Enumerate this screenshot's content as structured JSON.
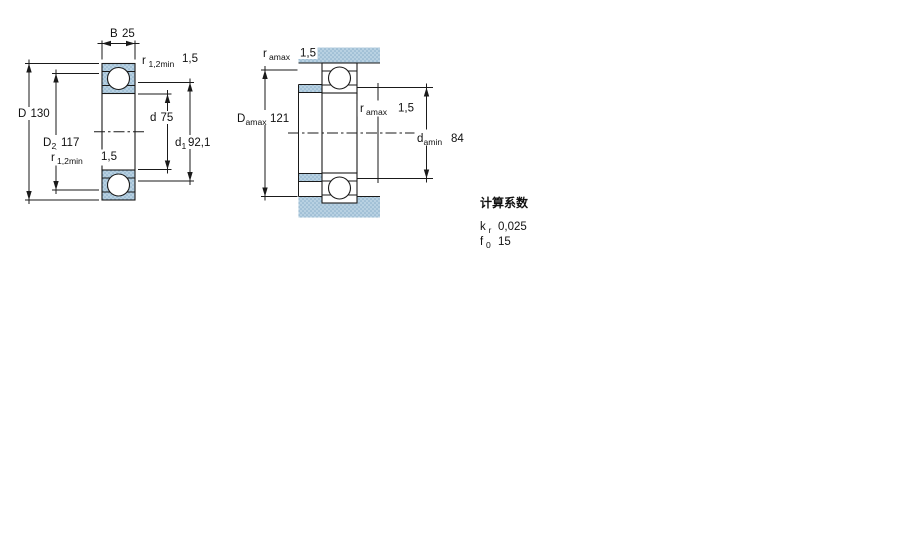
{
  "colors": {
    "part_fill": "#b8d1e2",
    "part_fill_dot": "#85abc6",
    "line_color": "#1a1a1a"
  },
  "left_view": {
    "dims": {
      "B": {
        "symbol": "B",
        "value": "25"
      },
      "r12_top": {
        "symbol": "r",
        "sub": "1,2min",
        "value": "1,5"
      },
      "D": {
        "symbol": "D",
        "value": "130"
      },
      "D2": {
        "symbol": "D",
        "sub": "2",
        "value": "117"
      },
      "d": {
        "symbol": "d",
        "value": "75"
      },
      "d1": {
        "symbol": "d",
        "sub": "1",
        "value": "92,1"
      },
      "r12_bottom": {
        "symbol": "r",
        "sub": "1,2min",
        "value": "1,5"
      }
    }
  },
  "right_view": {
    "dims": {
      "ra_top": {
        "symbol": "r",
        "sub": "amax",
        "value": "1,5"
      },
      "Da": {
        "symbol": "D",
        "sub": "amax",
        "value": "121"
      },
      "ra_side": {
        "symbol": "r",
        "sub": "amax",
        "value": "1,5"
      },
      "da": {
        "symbol": "d",
        "sub": "amin",
        "value": "84"
      }
    }
  },
  "calculation_factors": {
    "title": "计算系数",
    "rows": [
      {
        "symbol": "k",
        "sub": "r",
        "value": "0,025"
      },
      {
        "symbol": "f",
        "sub": "0",
        "value": "15"
      }
    ]
  }
}
